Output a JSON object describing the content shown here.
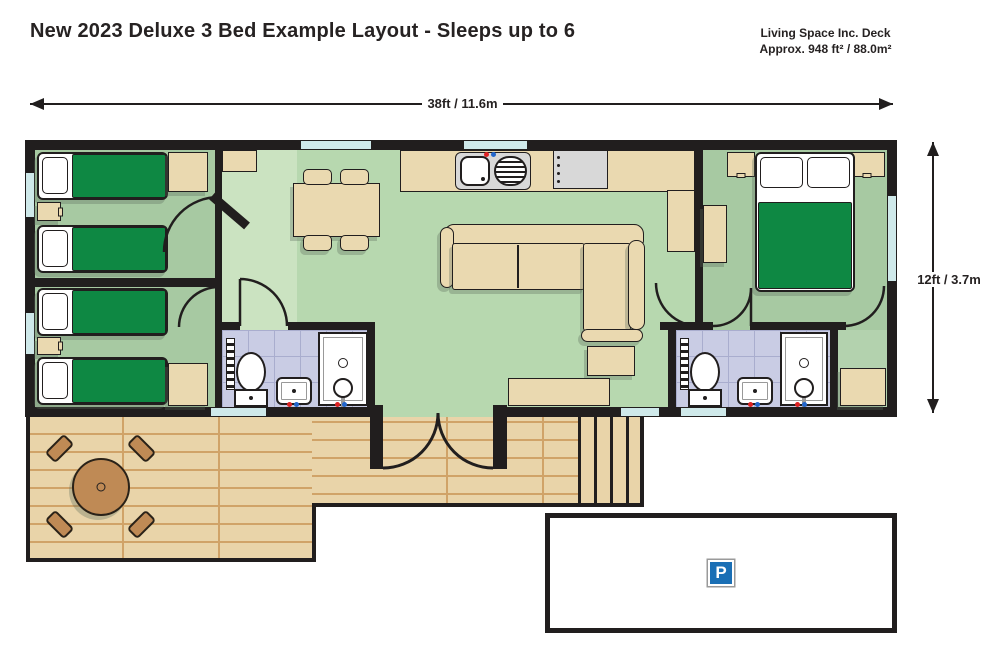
{
  "header": {
    "title": "New 2023 Deluxe 3 Bed Example Layout - Sleeps up to 6",
    "area_note_line1": "Living Space Inc. Deck",
    "area_note_line2": "Approx. 948 ft² / 88.0m²"
  },
  "dimensions": {
    "width_label": "38ft / 11.6m",
    "depth_label": "12ft / 3.7m"
  },
  "parking": {
    "sign_label": "P"
  },
  "colors": {
    "wall": "#211e1e",
    "floor_bedroom": "#a7c9a2",
    "floor_hall": "#cbe3c1",
    "floor_living": "#b7d8af",
    "tile": "#c9cce4",
    "duvet": "#0e8843",
    "tan": "#ead9b0",
    "deck_plank": "#e9d4a9",
    "deck_line": "#d0a368",
    "deck_wood": "#bf8a55",
    "window": "#cfe9ea",
    "parking_blue": "#1a6fb5",
    "appliance_grey": "#d8d8d8"
  }
}
